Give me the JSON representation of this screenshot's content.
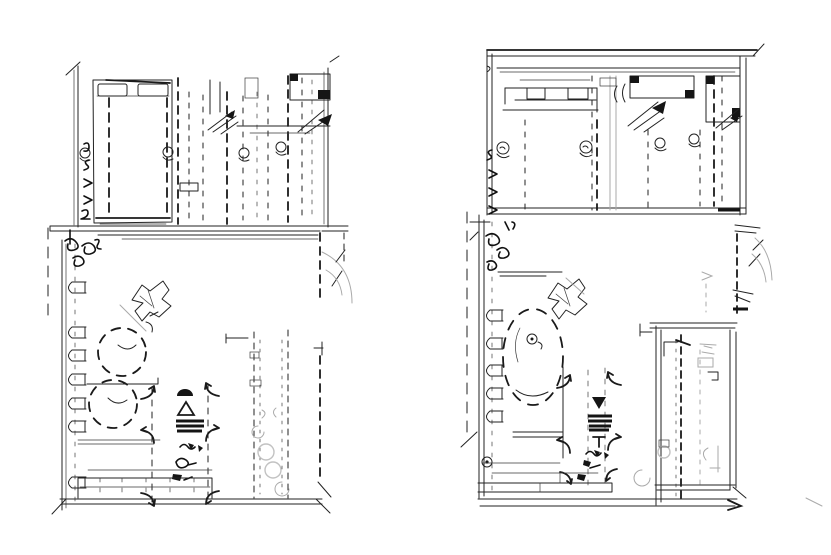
{
  "figure": {
    "description": "Pencil-style architectural sketch of two apartment floor plans side by side, black line work on white paper",
    "colors": {
      "paper": "#ffffff",
      "ink": "#1f1f1f",
      "bold_ink": "#141414",
      "faint": "#aaaaaa"
    },
    "panels": [
      {
        "id": "left-plan",
        "position": "left",
        "border_style": "open sketchy walls",
        "rooms": [
          {
            "name": "bedroom-wardrobe-room",
            "furniture": [
              "double-bed-with-two-pillows",
              "dashed-sliding-wardrobe-fronts",
              "door-knob-circles",
              "overhead-cabinets",
              "leaf-plant-strokes",
              "margin-squiggle-glyphs"
            ]
          },
          {
            "name": "living-dining-room",
            "furniture": [
              "coat-rack-scribble",
              "wall-chairs-row",
              "two-dashed-round-tables",
              "crumpled-plant-sketch",
              "stair-strip-with-corner-arrows",
              "dark-stove-plant-glyph-column",
              "kitchen-counter-band",
              "faint-sink-circles",
              "door-swing-arc",
              "window-sill-double-bar"
            ]
          }
        ]
      },
      {
        "id": "right-plan",
        "position": "right",
        "border_style": "heavy double rectangular border",
        "rooms": [
          {
            "name": "bedroom-wardrobe-room",
            "furniture": [
              "bed-with-two-pillows",
              "dashed-sliding-wardrobe-fronts",
              "door-knob-spiral-circles",
              "overhead-cabinets-with-dark-corners",
              "leaf-plant-strokes",
              "margin-squiggle-glyphs"
            ]
          },
          {
            "name": "living-dining-room",
            "furniture": [
              "coat-rack-scribble",
              "wall-chairs-row",
              "dashed-oval-dining-table-with-spiral-knob",
              "crumpled-plant-sketch",
              "stair-strip-with-corner-arrows",
              "dark-stove-plant-glyph-column",
              "counter-band",
              "target-spiral-mark"
            ]
          },
          {
            "name": "bathroom-block",
            "furniture": [
              "double-walls",
              "bold-dashed-partition",
              "toilet-circle",
              "faint-basin-arcs",
              "fixture-brackets",
              "door-swing-ticks"
            ]
          }
        ],
        "extras": [
          "long-bottom-baseline-with-arrow-ticks",
          "faint-hall-door-arcs-right"
        ]
      }
    ]
  }
}
